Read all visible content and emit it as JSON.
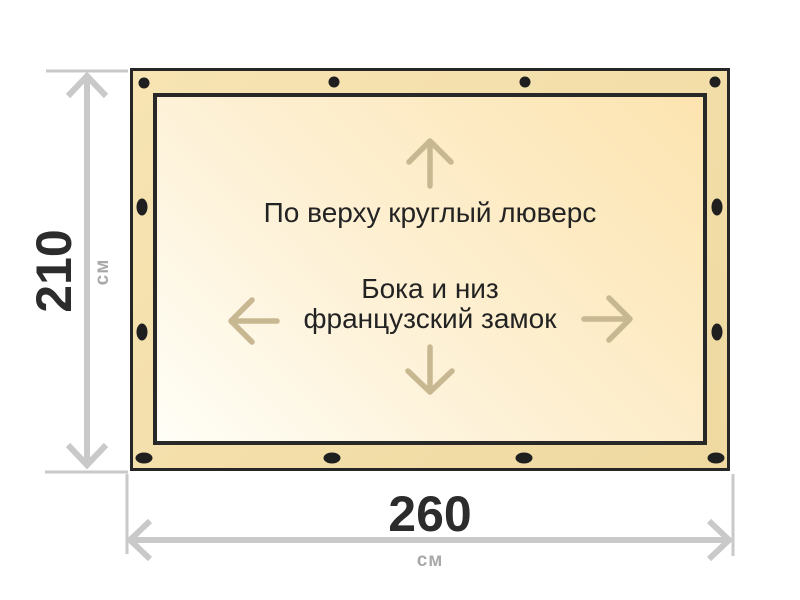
{
  "dimensions": {
    "height": {
      "value": "210",
      "unit": "см"
    },
    "width": {
      "value": "260",
      "unit": "см"
    }
  },
  "annotations": {
    "top_edge": "По верху круглый люверс",
    "sides_line1": "Бока и низ",
    "sides_line2": "французский замок"
  },
  "icons": {
    "grommets_top": "round grommet dots (4)",
    "grommets_sides": "vertical oval grommet dots (2 per side)",
    "grommets_bottom": "horizontal oval grommet dots (4)",
    "direction_arrows": [
      "arrow-up-icon",
      "arrow-down-icon",
      "arrow-left-icon",
      "arrow-right-icon"
    ]
  },
  "colors": {
    "tarp_band": "#f3dea9",
    "tarp_border": "#262626",
    "inner_light": "#fffef7",
    "inner_deep": "#fde4b0",
    "grommet": "#1f1f1f",
    "dimension_gray": "#c9c9c9",
    "value_text": "#2c2c2c",
    "unit_text": "#a9a9a9",
    "annotation_text": "#232323",
    "annotation_arrow": "#c7b892"
  }
}
